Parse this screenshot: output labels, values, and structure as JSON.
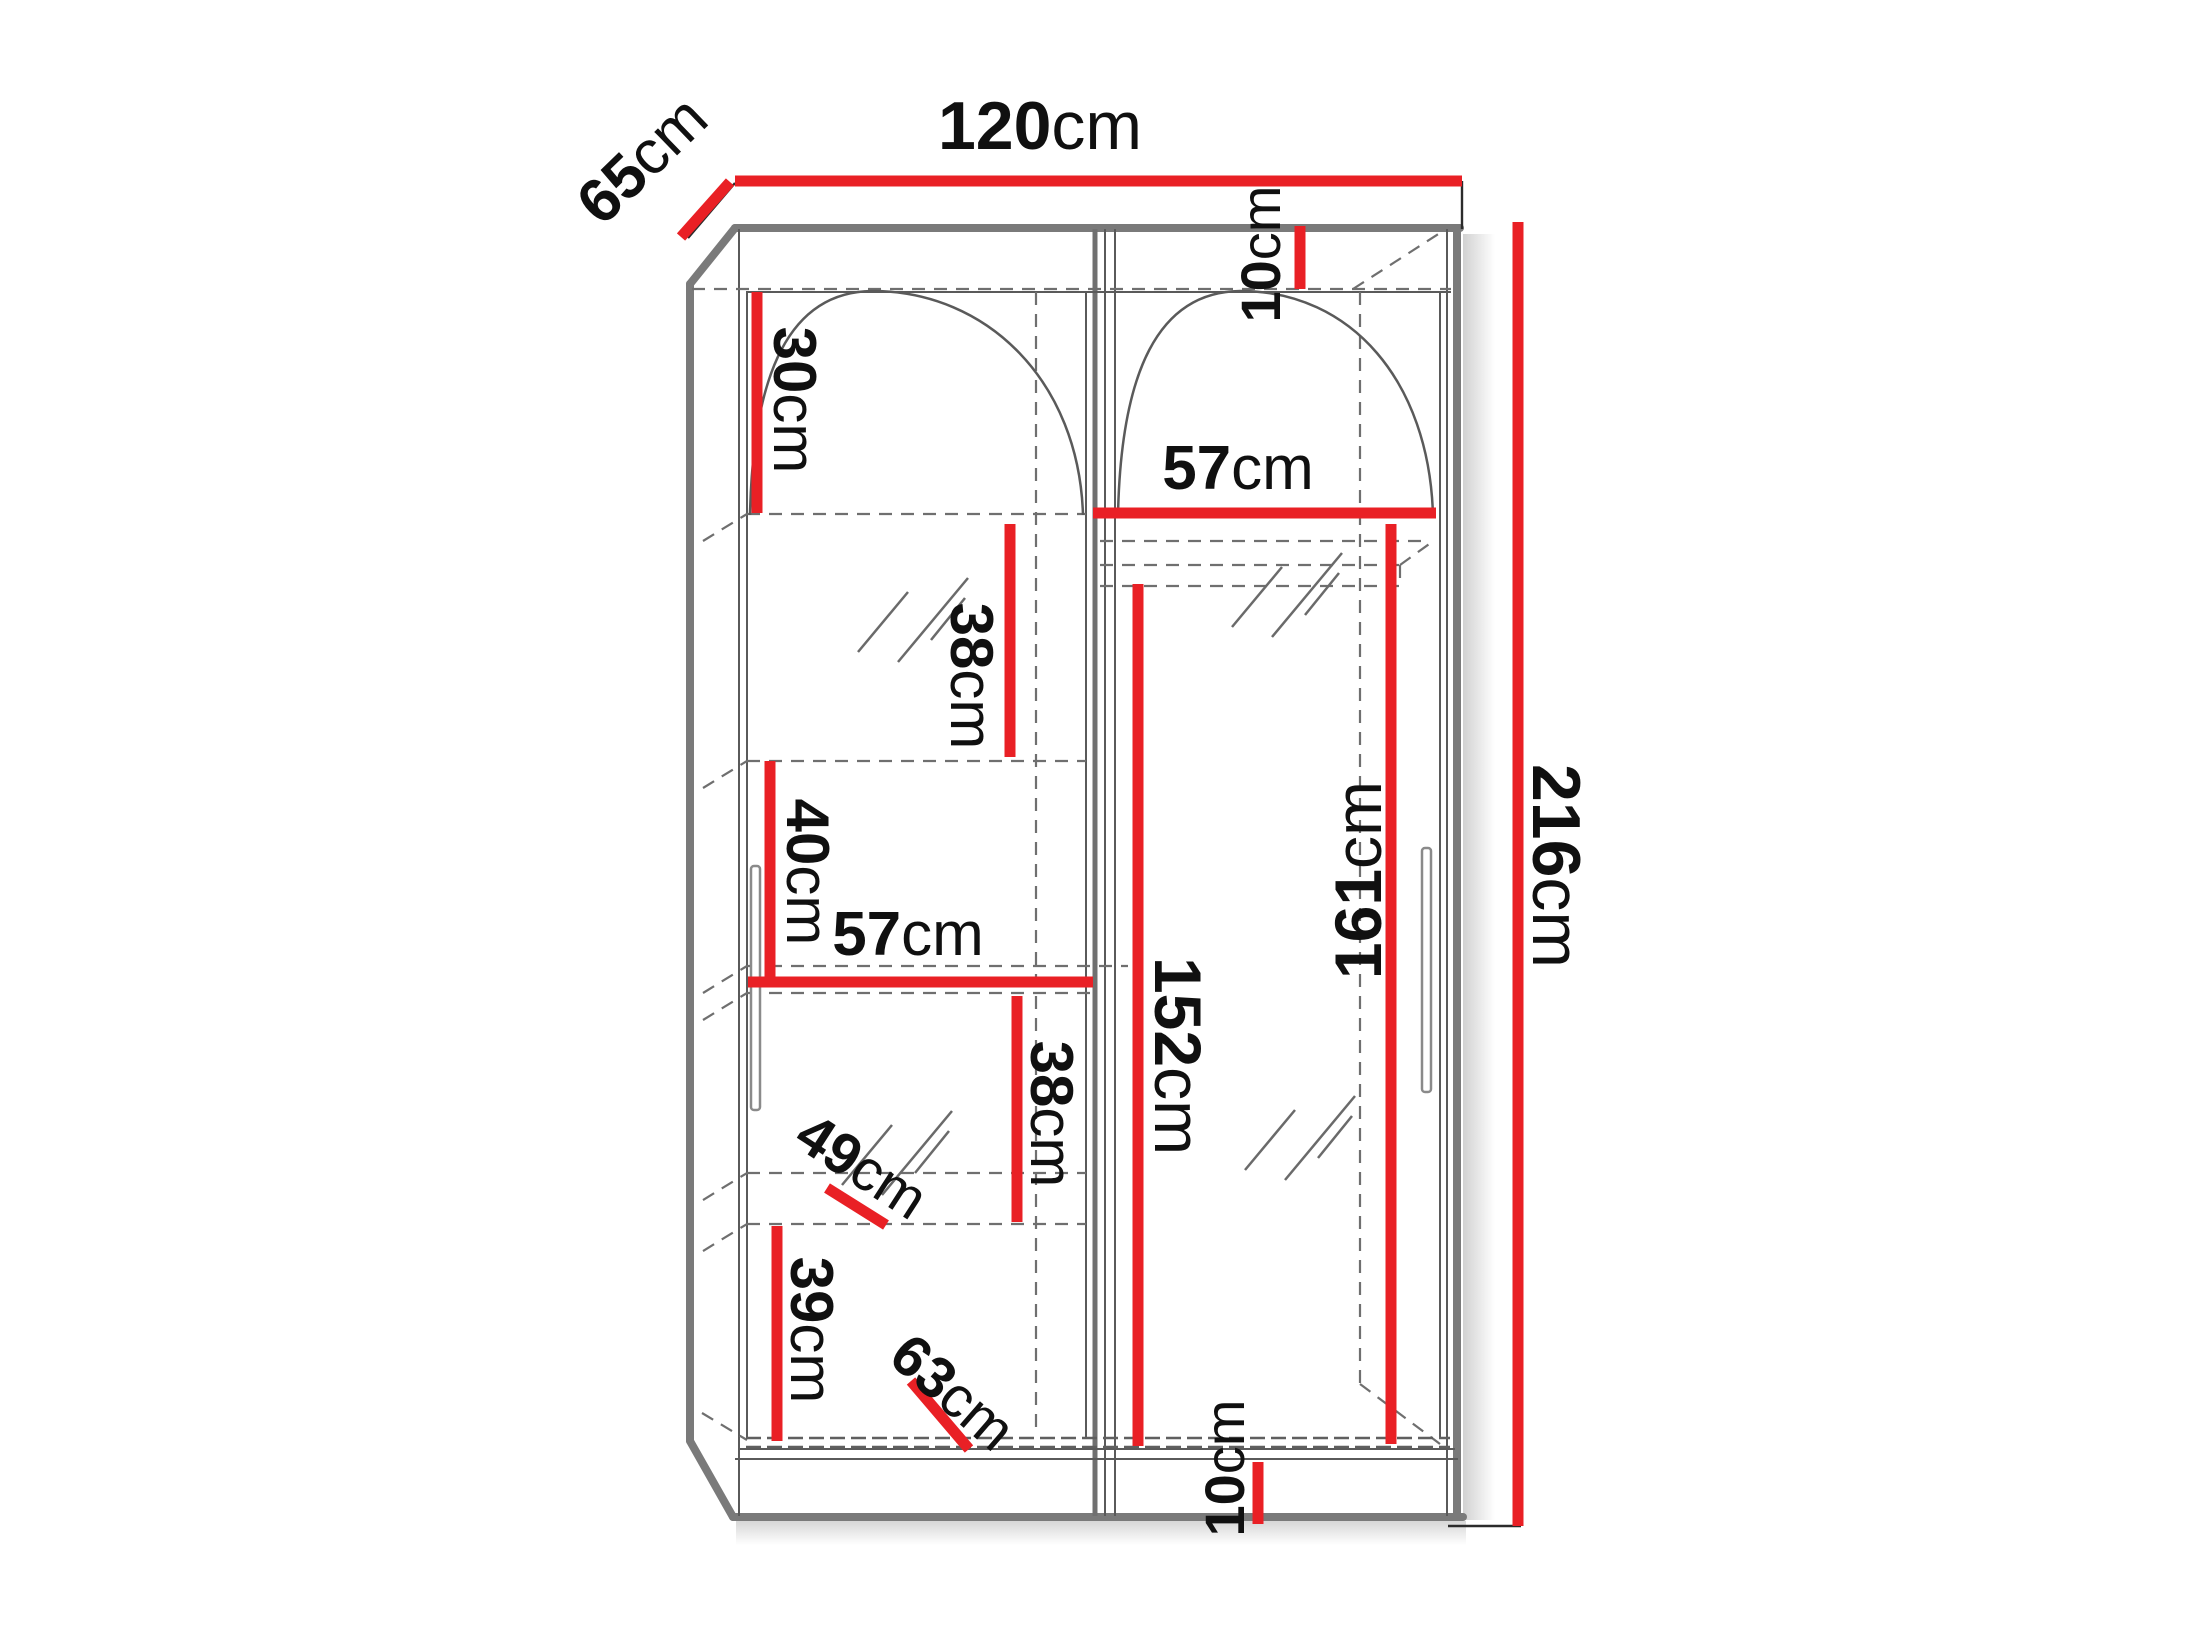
{
  "figure": {
    "type": "furniture-technical-drawing",
    "subject": "Sliding-door wardrobe dimension diagram",
    "unit": "cm",
    "overall": {
      "width_cm": 120,
      "depth_cm": 65,
      "height_cm": 216
    }
  },
  "colors": {
    "dimension_red": "#e92025",
    "outline_gray": "#7a7a7a",
    "line_gray": "#5a5a5a",
    "dashed_gray": "#6f6f6f",
    "text_black": "#101010",
    "background": "#ffffff"
  },
  "dimensions": [
    {
      "id": "overall-width",
      "value": "120",
      "unit": "cm",
      "line": {
        "x1": 735,
        "y1": 181,
        "x2": 1462,
        "y2": 181
      },
      "label": {
        "x": 1040,
        "y": 126,
        "rotate": 0,
        "size": 68
      }
    },
    {
      "id": "overall-depth",
      "value": "65",
      "unit": "cm",
      "line": {
        "x1": 681,
        "y1": 237,
        "x2": 730,
        "y2": 182
      },
      "label": {
        "x": 642,
        "y": 160,
        "rotate": -44,
        "size": 62
      }
    },
    {
      "id": "overall-height",
      "value": "216",
      "unit": "cm",
      "line": {
        "x1": 1518,
        "y1": 222,
        "x2": 1518,
        "y2": 1526
      },
      "label": {
        "x": 1556,
        "y": 866,
        "rotate": 90,
        "size": 68
      }
    },
    {
      "id": "top-panel-gap",
      "value": "10",
      "unit": "cm",
      "line": {
        "x1": 1300,
        "y1": 226,
        "x2": 1300,
        "y2": 289
      },
      "label": {
        "x": 1260,
        "y": 254,
        "rotate": -90,
        "size": 56
      }
    },
    {
      "id": "shelf-space-30",
      "value": "30",
      "unit": "cm",
      "line": {
        "x1": 757,
        "y1": 292,
        "x2": 757,
        "y2": 513
      },
      "label": {
        "x": 795,
        "y": 400,
        "rotate": 90,
        "size": 60
      }
    },
    {
      "id": "shelf-space-38a",
      "value": "38",
      "unit": "cm",
      "line": {
        "x1": 1010,
        "y1": 524,
        "x2": 1010,
        "y2": 757
      },
      "label": {
        "x": 972,
        "y": 676,
        "rotate": 90,
        "size": 60
      }
    },
    {
      "id": "shelf-space-40",
      "value": "40",
      "unit": "cm",
      "line": {
        "x1": 770,
        "y1": 761,
        "x2": 770,
        "y2": 980
      },
      "label": {
        "x": 808,
        "y": 872,
        "rotate": 90,
        "size": 60
      }
    },
    {
      "id": "shelf-width-57",
      "value": "57",
      "unit": "cm",
      "line": {
        "x1": 748,
        "y1": 982,
        "x2": 1093,
        "y2": 982
      },
      "label": {
        "x": 908,
        "y": 934,
        "rotate": 0,
        "size": 62
      }
    },
    {
      "id": "shelf-space-38b",
      "value": "38",
      "unit": "cm",
      "line": {
        "x1": 1017,
        "y1": 996,
        "x2": 1017,
        "y2": 1222
      },
      "label": {
        "x": 1052,
        "y": 1114,
        "rotate": 90,
        "size": 60
      }
    },
    {
      "id": "shelf-depth-49",
      "value": "49",
      "unit": "cm",
      "line": {
        "x1": 827,
        "y1": 1188,
        "x2": 886,
        "y2": 1225
      },
      "label": {
        "x": 862,
        "y": 1166,
        "rotate": 33,
        "size": 58
      }
    },
    {
      "id": "shelf-space-39",
      "value": "39",
      "unit": "cm",
      "line": {
        "x1": 777,
        "y1": 1226,
        "x2": 777,
        "y2": 1441
      },
      "label": {
        "x": 812,
        "y": 1330,
        "rotate": 90,
        "size": 60
      }
    },
    {
      "id": "bottom-width-63",
      "value": "63",
      "unit": "cm",
      "line": {
        "x1": 911,
        "y1": 1381,
        "x2": 969,
        "y2": 1449
      },
      "label": {
        "x": 953,
        "y": 1392,
        "rotate": 41,
        "size": 58
      }
    },
    {
      "id": "rail-width-57",
      "value": "57",
      "unit": "cm",
      "line": {
        "x1": 1093,
        "y1": 513,
        "x2": 1436,
        "y2": 513
      },
      "label": {
        "x": 1238,
        "y": 468,
        "rotate": 0,
        "size": 62
      }
    },
    {
      "id": "hang-height-152",
      "value": "152",
      "unit": "cm",
      "line": {
        "x1": 1138,
        "y1": 584,
        "x2": 1138,
        "y2": 1446
      },
      "label": {
        "x": 1178,
        "y": 1056,
        "rotate": 90,
        "size": 66
      }
    },
    {
      "id": "hang-height-161",
      "value": "161",
      "unit": "cm",
      "line": {
        "x1": 1391,
        "y1": 524,
        "x2": 1391,
        "y2": 1444
      },
      "label": {
        "x": 1358,
        "y": 880,
        "rotate": -90,
        "size": 66
      }
    },
    {
      "id": "plinth-height-10",
      "value": "10",
      "unit": "cm",
      "line": {
        "x1": 1258,
        "y1": 1462,
        "x2": 1258,
        "y2": 1524
      },
      "label": {
        "x": 1224,
        "y": 1468,
        "rotate": -90,
        "size": 56
      }
    }
  ],
  "icons": {
    "mirror_glass": "double-slash glass hatch",
    "mirror_marks": [
      {
        "x": 913,
        "y": 600
      },
      {
        "x": 897,
        "y": 1133
      },
      {
        "x": 1287,
        "y": 575
      },
      {
        "x": 1300,
        "y": 1118
      }
    ]
  }
}
